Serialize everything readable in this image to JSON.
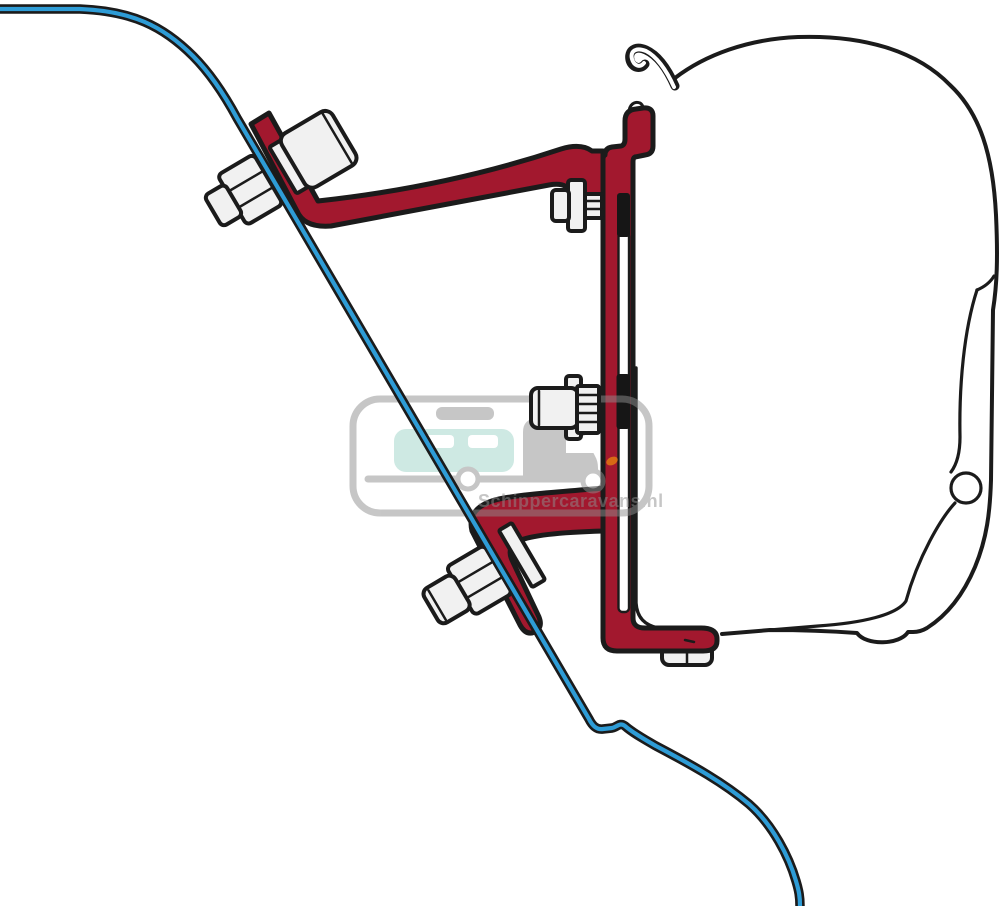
{
  "watermark": {
    "text": "Schippercaravans.nl"
  },
  "colors": {
    "background": "#ffffff",
    "outline": "#1b1b1b",
    "bracket_red": "#a2182e",
    "wall_blue": "#2e9cd6",
    "metal": "#f1f1f1",
    "clamp_black": "#161616",
    "watermark_gray": "#8f8f8f",
    "watermark_mint": "#9fd4c8",
    "watermark_orange": "#e8830d"
  },
  "parts": [
    {
      "name": "vehicle-wall-profile",
      "color_key": "wall_blue"
    },
    {
      "name": "awning-case-cross-section",
      "color_key": "background"
    },
    {
      "name": "adapter-bracket",
      "color_key": "bracket_red"
    },
    {
      "name": "mounting-bolts",
      "color_key": "metal"
    }
  ]
}
